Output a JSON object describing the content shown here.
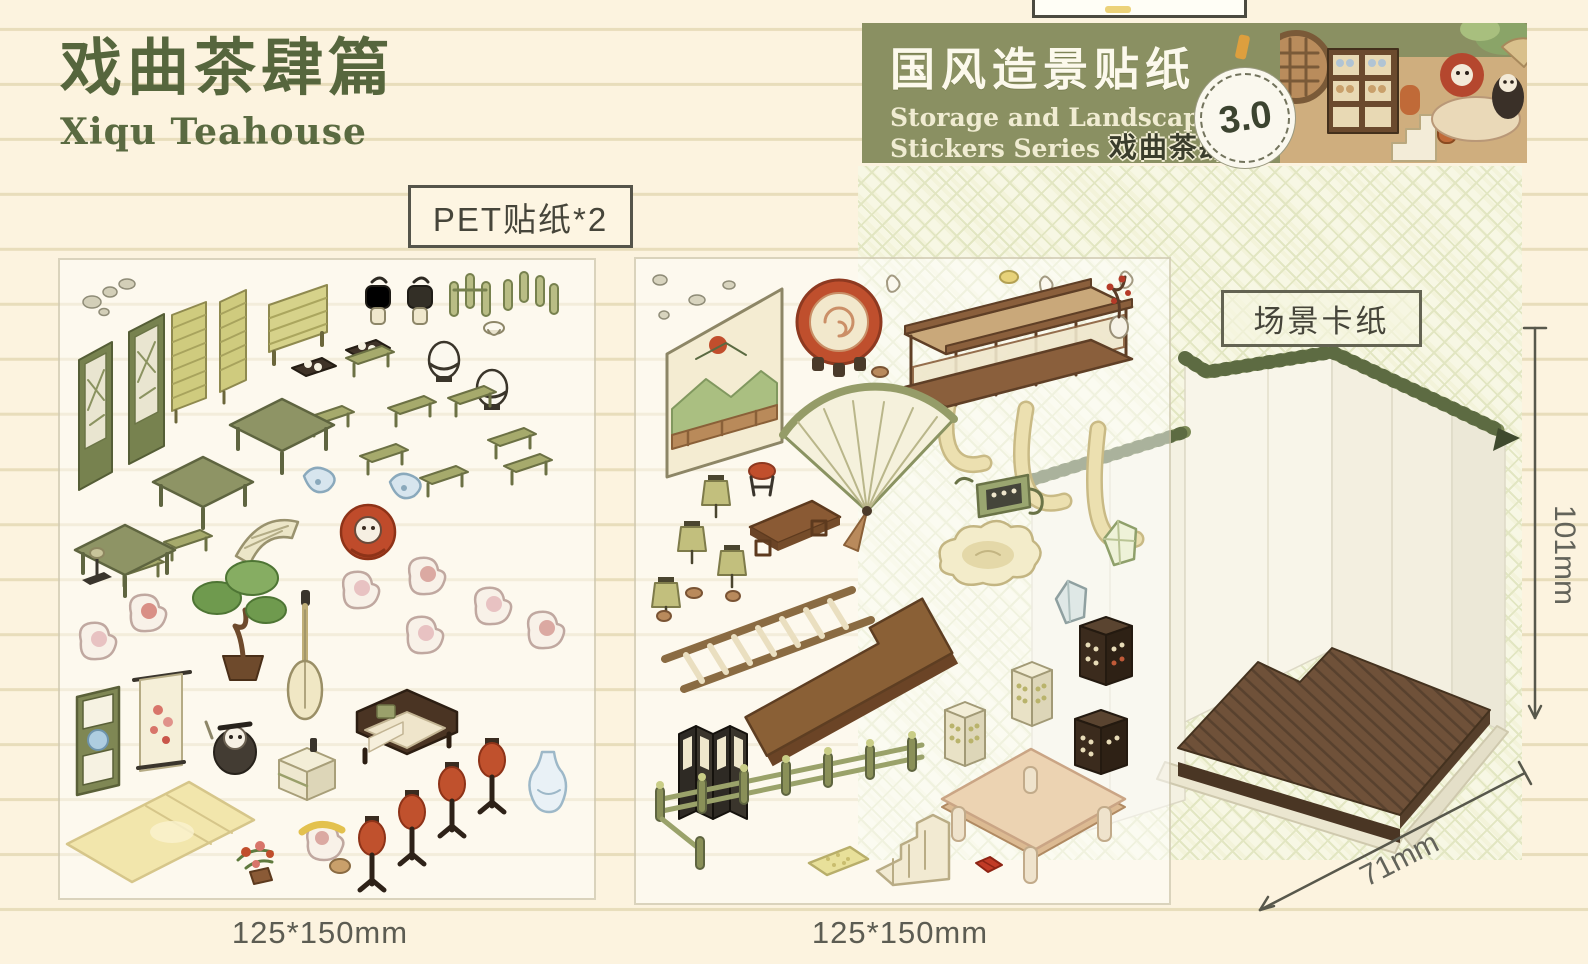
{
  "header": {
    "title_cn": "戏曲茶肆篇",
    "title_en": "Xiqu Teahouse"
  },
  "banner": {
    "title_cn": "国风造景贴纸",
    "subtitle_line1": "Storage and Landscape",
    "subtitle_line2": "Stickers Series",
    "series_cn": "戏曲茶肆篇",
    "badge_version": "3.0",
    "colors": {
      "background": "#8a9062",
      "title_text": "#fcf9ec",
      "subtitle_text": "#f0ecd2",
      "badge_text": "#3c4430"
    }
  },
  "labels": {
    "pet_sticker_count": "PET贴纸*2",
    "scene_card": "场景卡纸"
  },
  "sheets": [
    {
      "name": "PET sticker sheet 1",
      "size_label": "125*150mm",
      "items": [
        "pebbles",
        "carved lattice screen x2",
        "bamboo blind x2",
        "bamboo fence",
        "hanging lantern x2",
        "hook stand x2",
        "tea tray with cups x2",
        "white drum x2",
        "green bench x8",
        "green square table x3",
        "stone bridge piece",
        "blue porcelain bundle x2",
        "red-costume opera character",
        "white opera cat characters",
        "bonsai pine tree",
        "pipa lute",
        "green lattice door",
        "flower scroll painting",
        "tatami mat",
        "rat storyteller character",
        "shop counter",
        "wooden sofa with cushions",
        "red floor lantern x4",
        "blue-white vase",
        "potted flowers",
        "hat stand",
        "small teacup"
      ]
    },
    {
      "name": "PET sticker sheet 2",
      "size_label": "125*150mm",
      "items": [
        "pebbles",
        "mountain landscape painting",
        "red opera drum",
        "balcony railing with hanging banners",
        "plum branch in vase",
        "folding fan",
        "teahouse signboard",
        "olive lantern x4",
        "red stool",
        "brown low table",
        "wooden ladder",
        "cloud-shaped rug",
        "crystal gem x2",
        "L-shaped wooden platform",
        "dark folding screen",
        "green fence",
        "small stairs",
        "medicine cabinet x2",
        "dark bottle cabinet x2",
        "large beige table",
        "red cushion",
        "yellow mat",
        "small dishes"
      ]
    }
  ],
  "scene_card": {
    "label": "场景卡纸",
    "height_label": "101mm",
    "depth_label": "71mm",
    "wall_color": "#f6f3e6",
    "roof_tile_color": "#7d8b57",
    "floor_color": "#6f5139"
  },
  "colors": {
    "page_background": "#fcf3df",
    "ruled_line": "#e8ddbb",
    "title_green": "#56663d",
    "pattern_panel": "#f3f3da",
    "pattern_line": "#e2e6c2",
    "label_border": "#55544a",
    "dimension_text": "#63635a"
  }
}
